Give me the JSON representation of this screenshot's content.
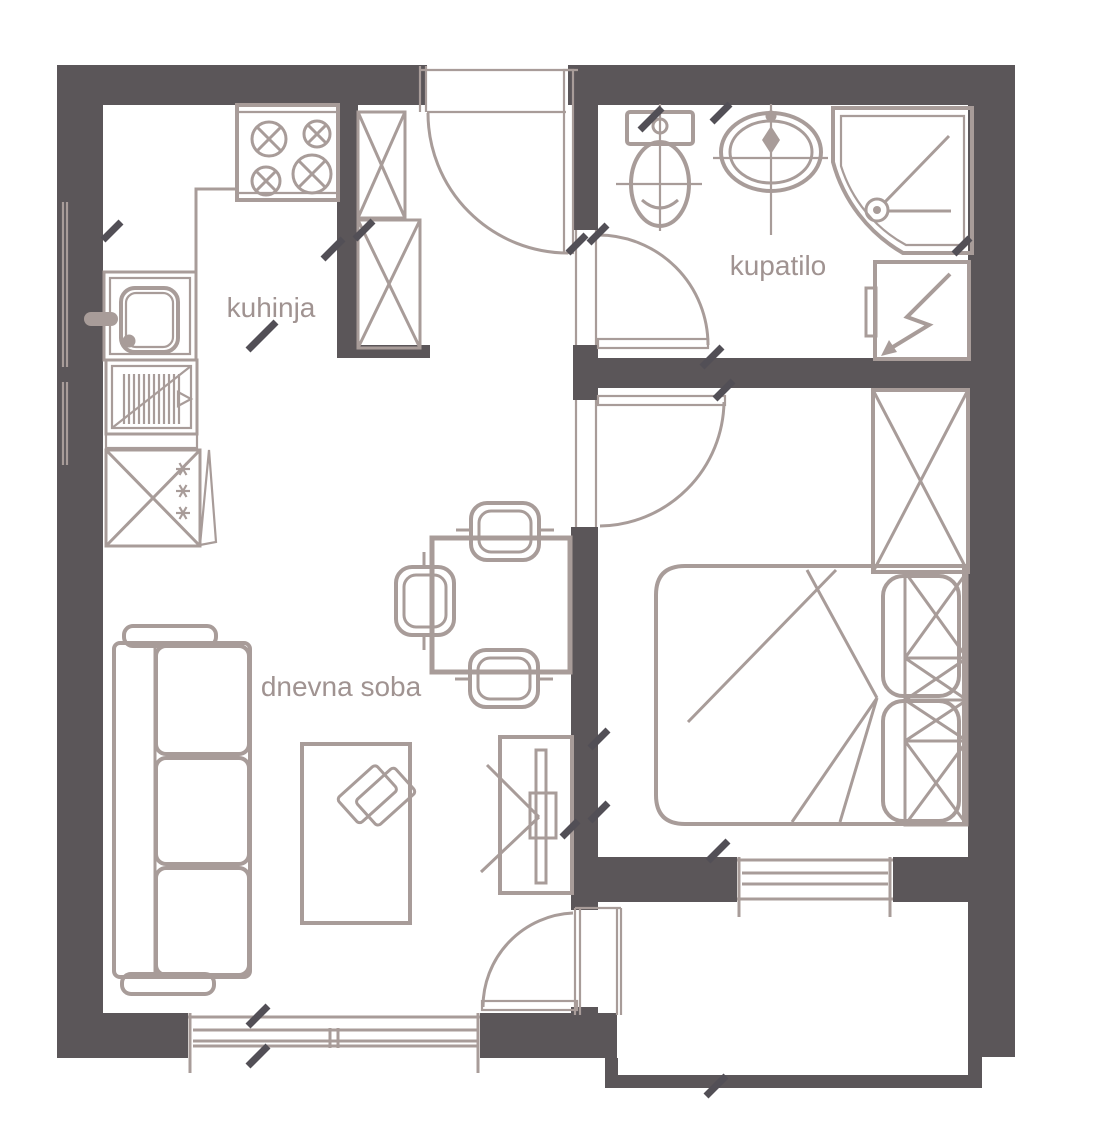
{
  "floorplan": {
    "rooms": {
      "kitchen": {
        "label": "kuhinja"
      },
      "bathroom": {
        "label": "kupatilo"
      },
      "living_room": {
        "label": "dnevna soba"
      }
    },
    "colors": {
      "wall": "#5b5659",
      "furniture_line": "#a89c99",
      "label_text": "#a09391",
      "tick_mark": "#524f56",
      "background": "#ffffff"
    }
  }
}
